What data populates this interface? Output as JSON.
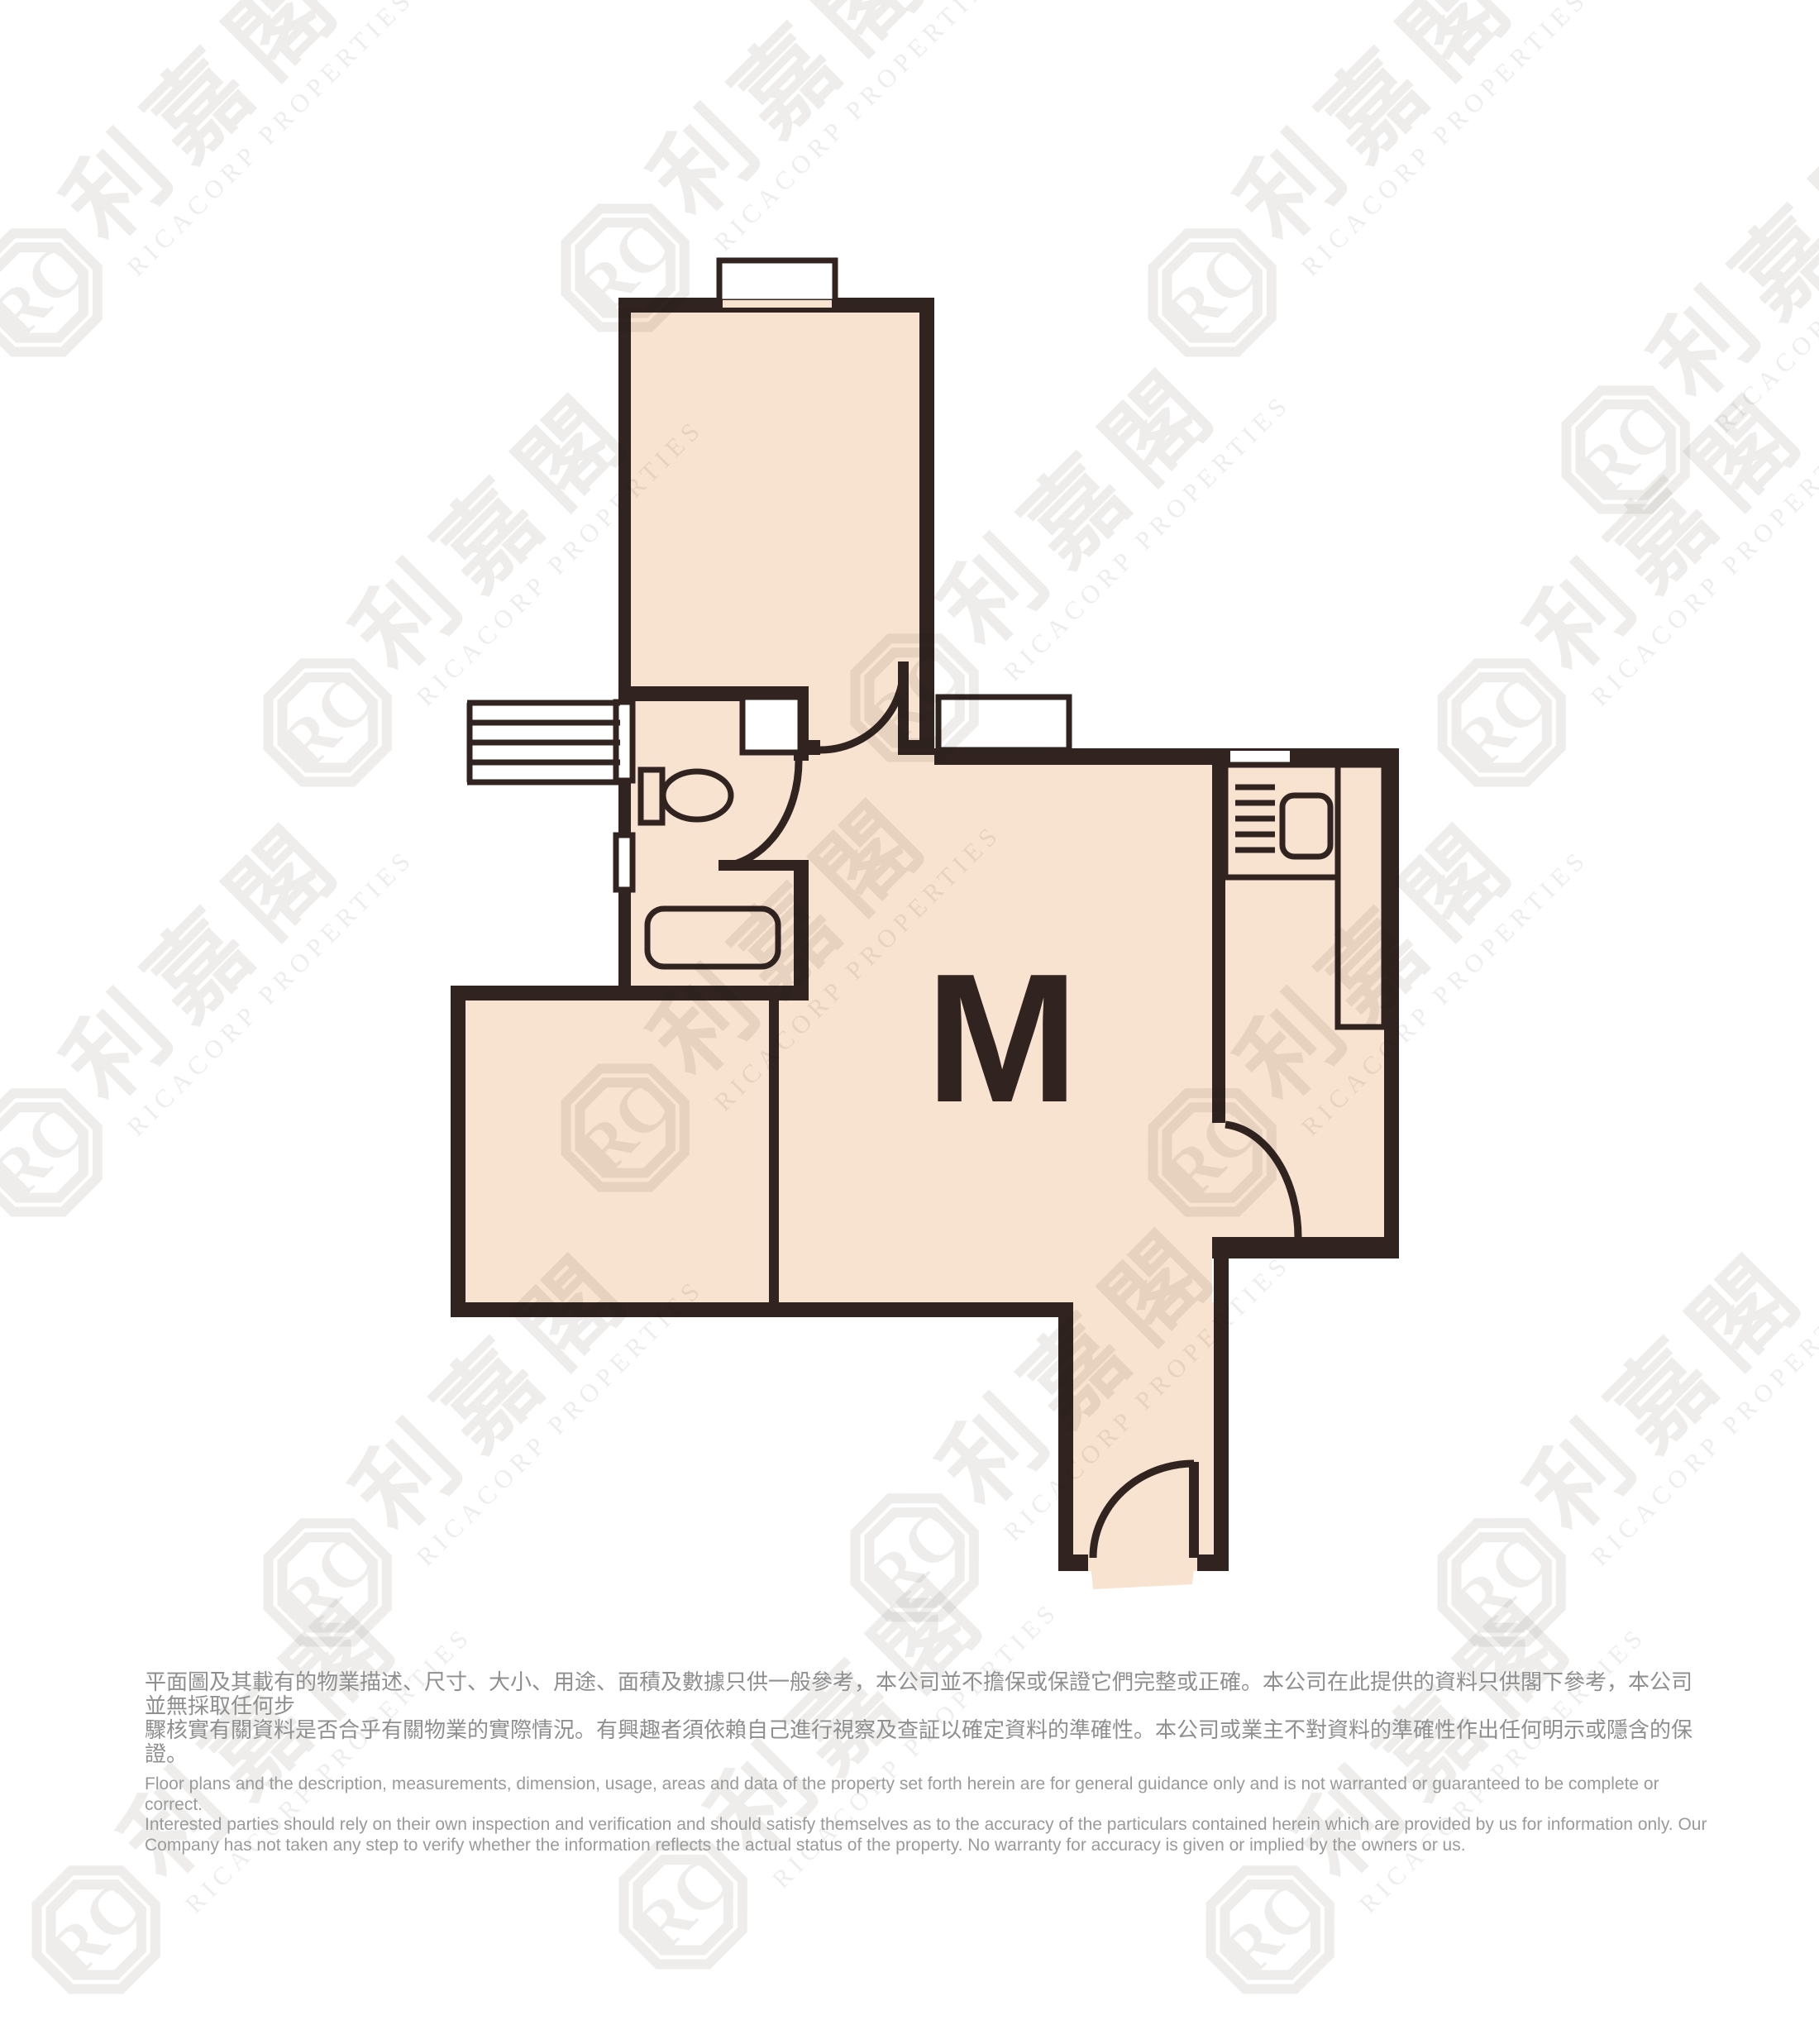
{
  "floor_plan": {
    "unit_label": "M",
    "rooms": [
      "bedroom",
      "bathroom",
      "living-dining",
      "second-room",
      "kitchen",
      "entrance-corridor"
    ],
    "fixtures": [
      "toilet",
      "bathtub",
      "stove",
      "sink",
      "kitchen-counter",
      "ac-louvre",
      "shaft"
    ]
  },
  "watermark": {
    "logo": "RC",
    "cjk": "利嘉閣",
    "latin": "RICACORP PROPERTIES"
  },
  "disclaimer": {
    "zh_lines": [
      "平面圖及其載有的物業描述、尺寸、大小、用途、面積及數據只供一般參考，本公司並不擔保或保證它們完整或正確。本公司在此提供的資料只供閣下參考，本公司並無採取任何步",
      "驟核實有關資料是否合乎有關物業的實際情況。有興趣者須依賴自己進行視察及查証以確定資料的準確性。本公司或業主不對資料的準確性作出任何明示或隱含的保證。"
    ],
    "en_lines": [
      "Floor plans and the description, measurements, dimension, usage, areas and data of the property set forth herein are for general guidance only and is not warranted or guaranteed to be complete or correct.",
      "Interested parties should rely on their own inspection and verification and should satisfy themselves as to the accuracy of the particulars contained herein which are provided by us for information only.  Our",
      "Company has not taken any step to verify whether the information reflects the actual status of the property.  No warranty for accuracy is given or implied by the owners or us."
    ]
  },
  "colors": {
    "background": "#ffffff",
    "floor_fill": "#f8e2d0",
    "wall": "#312420",
    "watermark": "#8a8178",
    "disclaimer_text": "#8f8f8f"
  }
}
